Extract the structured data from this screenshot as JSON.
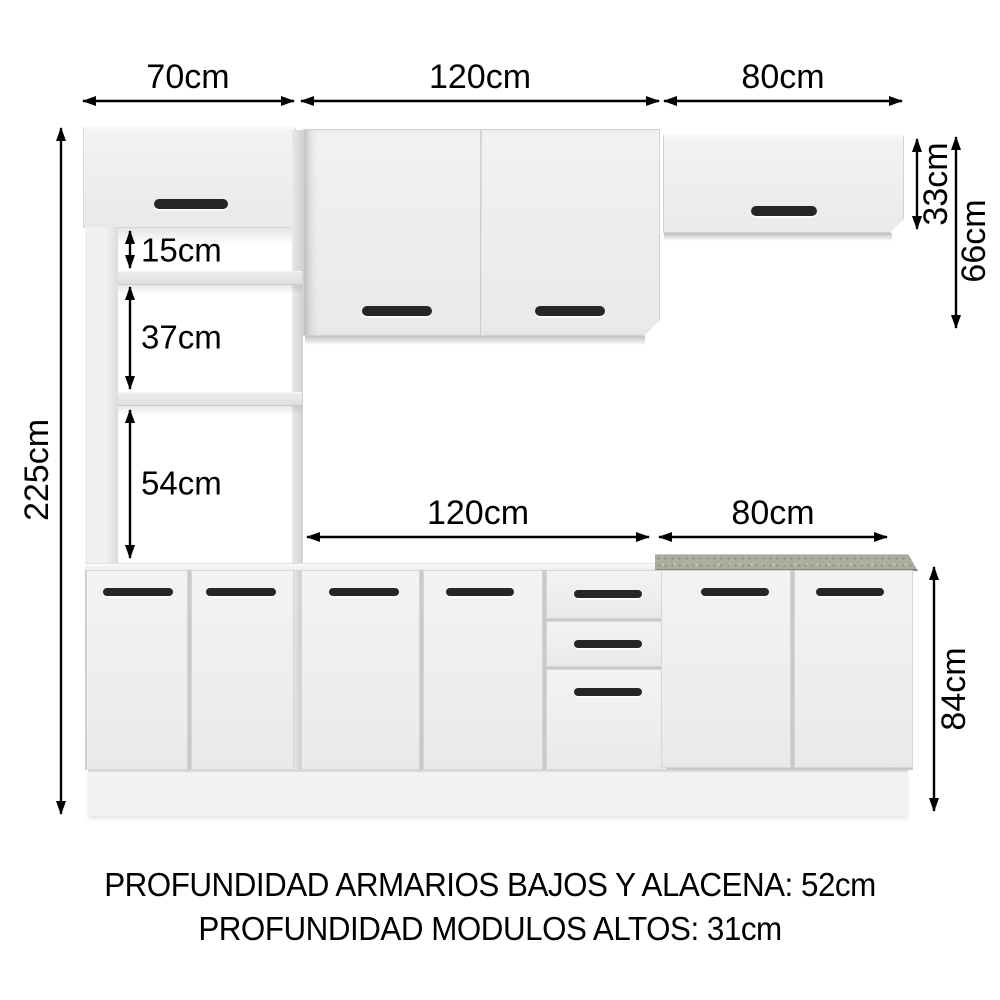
{
  "dimensions": {
    "top_tower_width": "70cm",
    "top_wall120_width": "120cm",
    "top_wall80_width": "80cm",
    "total_height": "225cm",
    "shelf_gap_1": "15cm",
    "shelf_gap_2": "37cm",
    "shelf_gap_3": "54cm",
    "base_120_width": "120cm",
    "base_80_width": "80cm",
    "wall80_height": "33cm",
    "wall80_total_height": "66cm",
    "base_height": "84cm"
  },
  "footer": {
    "line1": "PROFUNDIDAD ARMARIOS BAJOS Y ALACENA: 52cm",
    "line2": "PROFUNDIDAD MODULOS ALTOS: 31cm"
  },
  "colors": {
    "background": "#ffffff",
    "cabinet_face": "#efefef",
    "handle": "#262626",
    "countertop": "#abae9f",
    "countertop_dot_dark": "#8f9383",
    "countertop_dot_light": "#c9ccbd",
    "dimension_line": "#000000"
  }
}
